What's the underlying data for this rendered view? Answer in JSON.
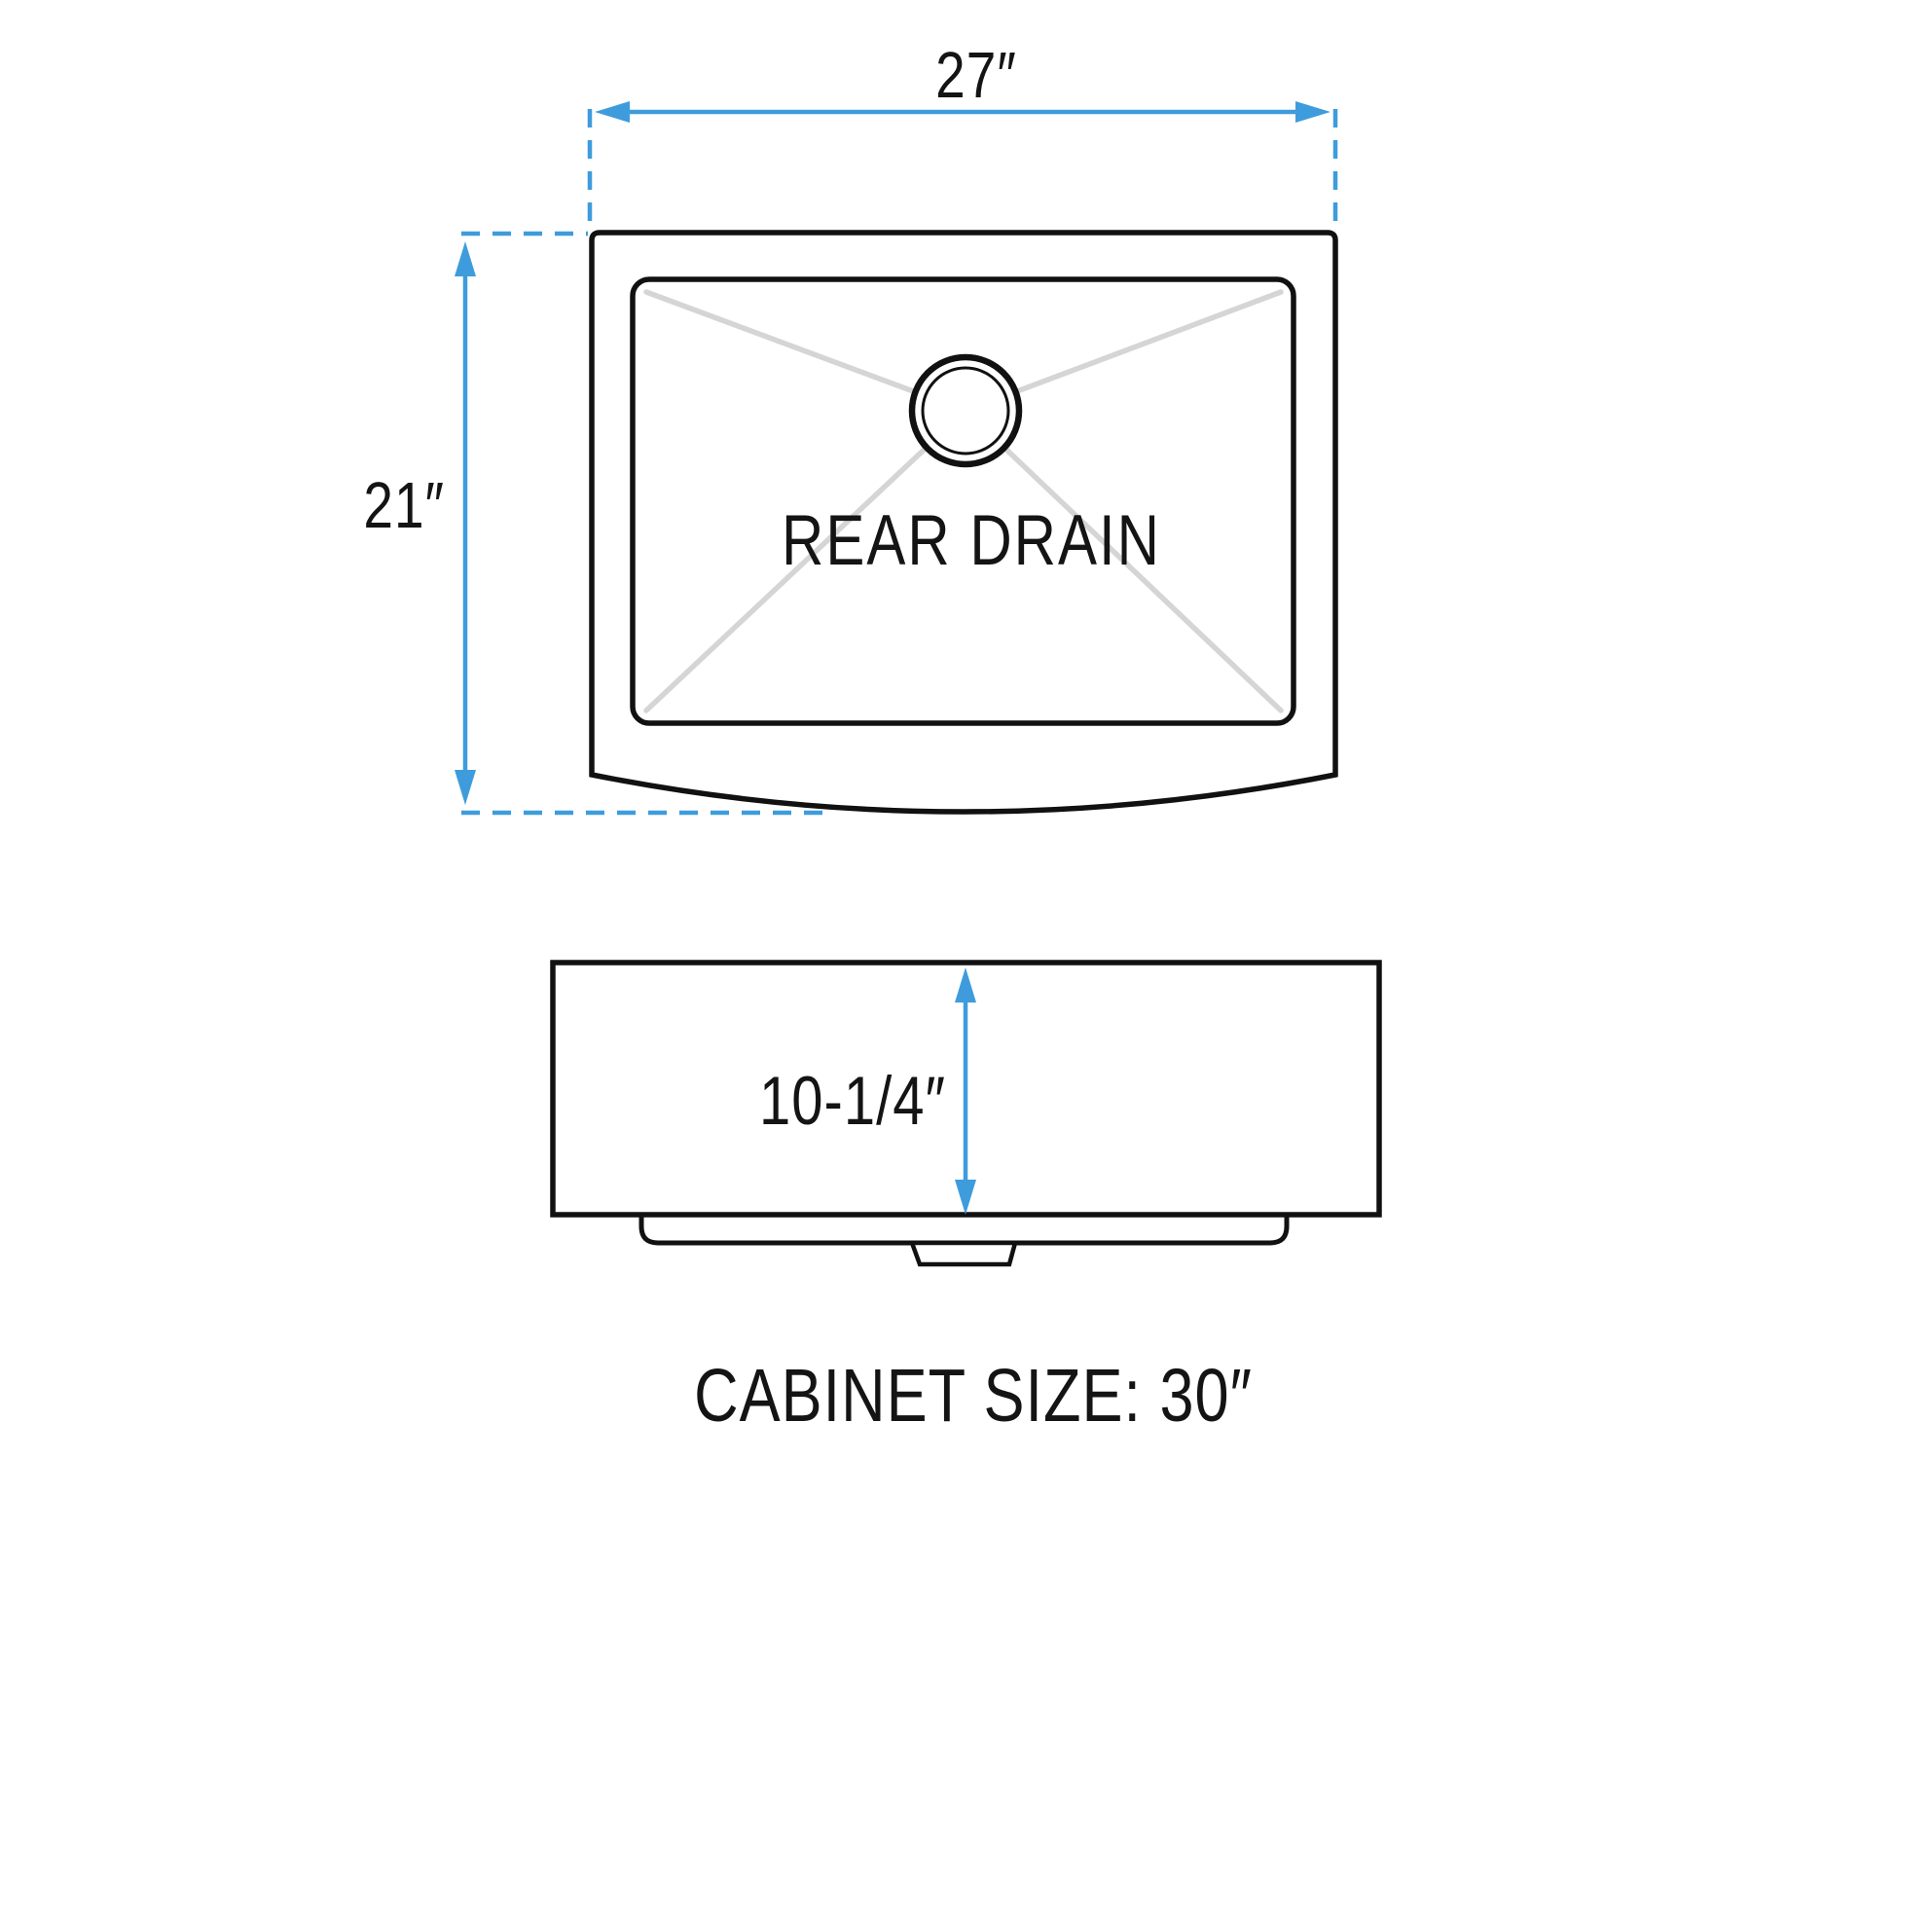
{
  "diagram": {
    "caption": "CABINET SIZE: 30″",
    "top_view": {
      "drain_label": "REAR DRAIN",
      "width_dimension": "27″",
      "depth_dimension": "21″"
    },
    "side_view": {
      "height_dimension": "10-1/4″"
    },
    "colors": {
      "dimension_blue": "#3e9cdc",
      "line_black": "#111111",
      "cross_gray": "#d5d5d5"
    }
  }
}
